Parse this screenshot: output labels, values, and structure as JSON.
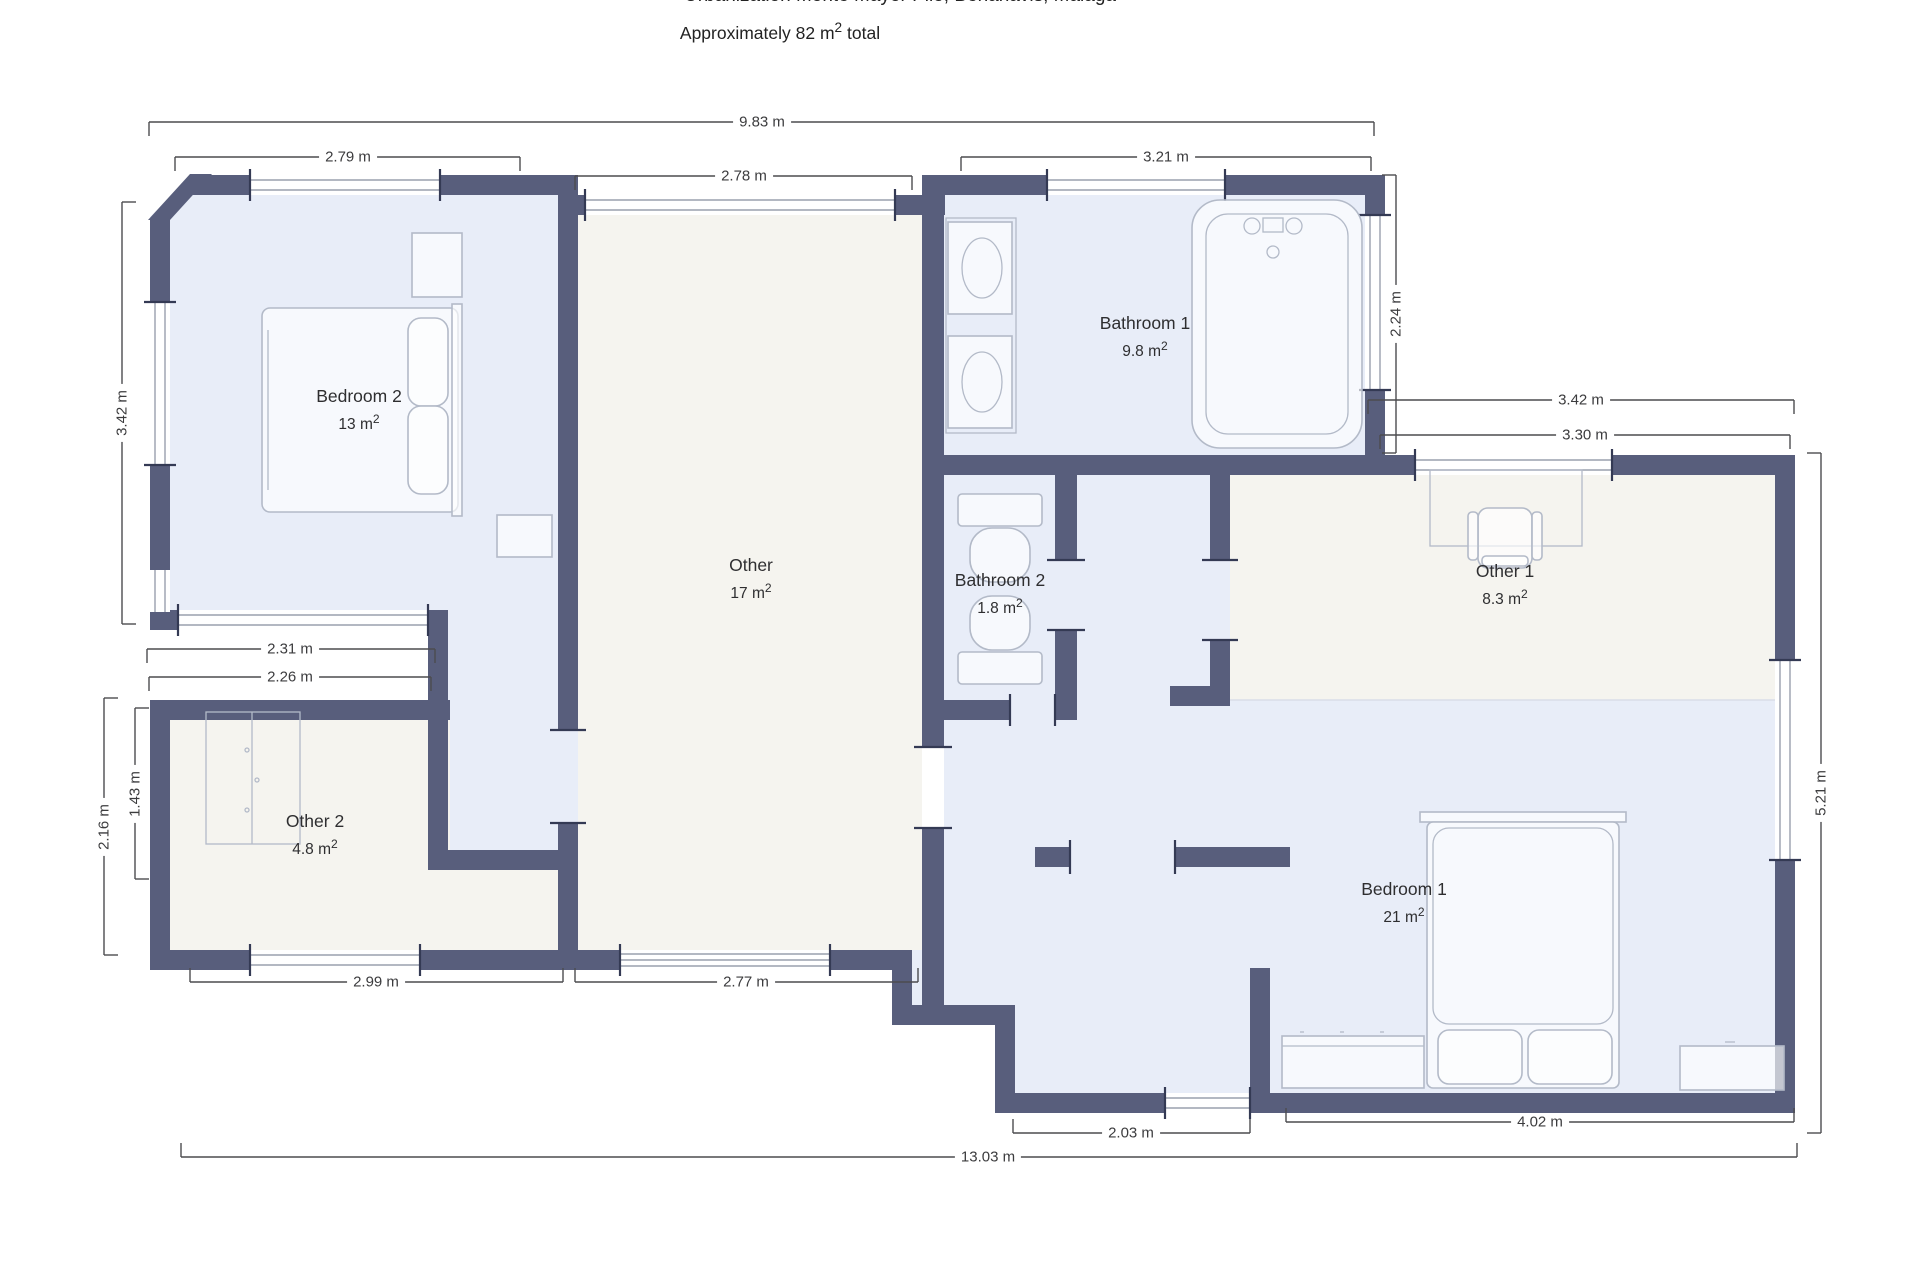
{
  "header": {
    "address_line": "Urbanization Monte Mayor Pilo, Benahavis, Malaga",
    "subtitle_prefix": "Approximately 82 m",
    "subtitle_sup": "2",
    "subtitle_suffix": " total"
  },
  "rooms": {
    "bedroom2": {
      "name": "Bedroom 2",
      "area": "13 m",
      "sup": "2"
    },
    "other": {
      "name": "Other",
      "area": "17 m",
      "sup": "2"
    },
    "bathroom1": {
      "name": "Bathroom 1",
      "area": "9.8 m",
      "sup": "2"
    },
    "bathroom2": {
      "name": "Bathroom 2",
      "area": "1.8 m",
      "sup": "2"
    },
    "other1": {
      "name": "Other 1",
      "area": "8.3 m",
      "sup": "2"
    },
    "other2": {
      "name": "Other 2",
      "area": "4.8 m",
      "sup": "2"
    },
    "bedroom1": {
      "name": "Bedroom 1",
      "area": "21 m",
      "sup": "2"
    }
  },
  "dimensions": {
    "overall_top": "9.83 m",
    "bedroom2_top": "2.79 m",
    "other_top": "2.78 m",
    "bathroom1_top": "3.21 m",
    "bathroom1_right": "2.24 m",
    "bedroom2_left": "3.42 m",
    "other1_top_outer": "3.42 m",
    "other1_top_inner": "3.30 m",
    "right_side": "5.21 m",
    "bedroom2_bottom_outer": "2.31 m",
    "bedroom2_bottom_inner": "2.26 m",
    "other2_left_outer": "2.16 m",
    "other2_left_inner": "1.43 m",
    "other2_bottom": "2.99 m",
    "other_bottom": "2.77 m",
    "entry_bottom": "2.03 m",
    "bedroom1_bottom": "4.02 m",
    "overall_bottom": "13.03 m"
  },
  "colors": {
    "wall": "#585e7c",
    "room_blue": "#e8edf8",
    "room_beige": "#f5f4ef",
    "dim_line": "#4c4c4f",
    "furniture_line": "#b3bac8"
  }
}
